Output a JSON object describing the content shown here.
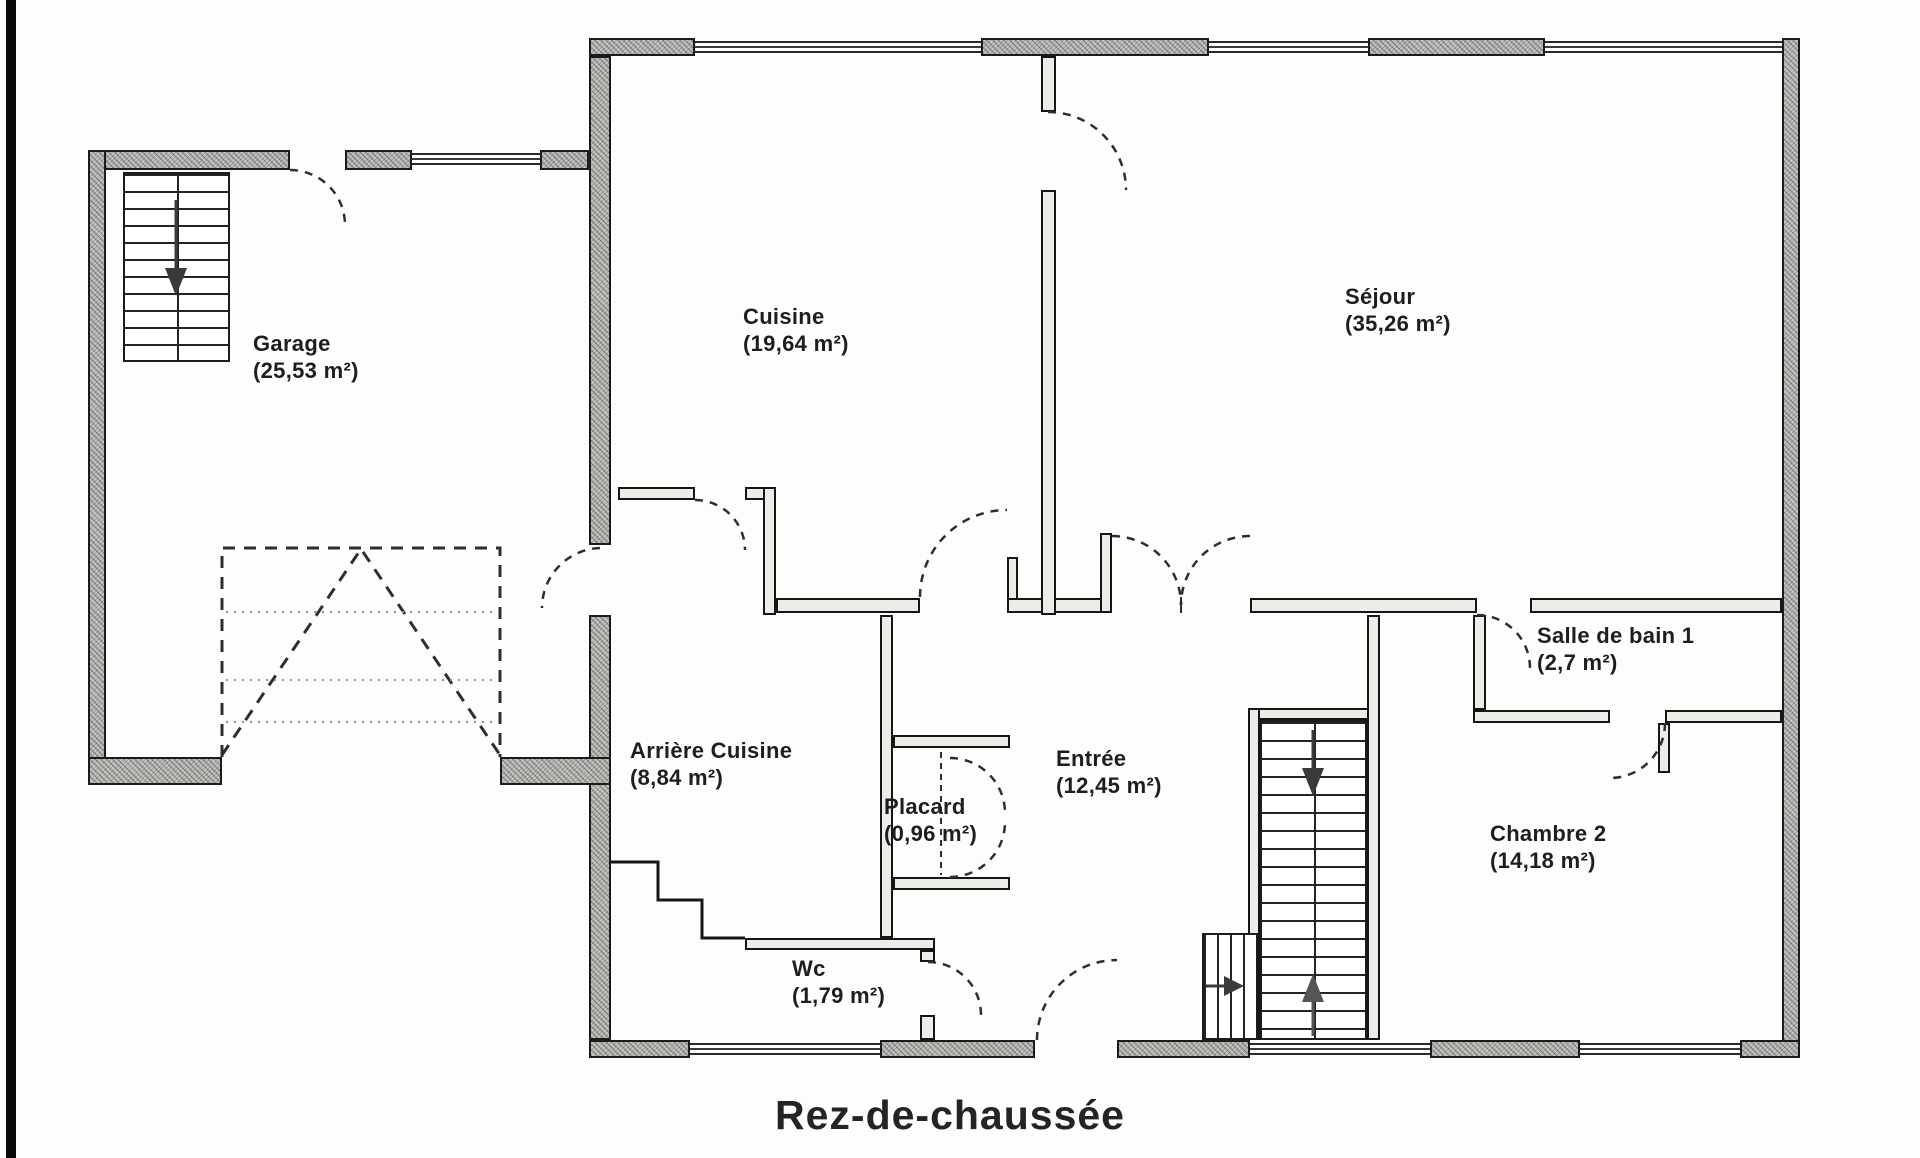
{
  "page": {
    "title": "Rez-de-chaussée"
  },
  "floor_plan": {
    "rooms": [
      {
        "id": "garage",
        "name": "Garage",
        "area": "(25,53 m²)"
      },
      {
        "id": "cuisine",
        "name": "Cuisine",
        "area": "(19,64 m²)"
      },
      {
        "id": "sejour",
        "name": "Séjour",
        "area": "(35,26 m²)"
      },
      {
        "id": "arriere-cuisine",
        "name": "Arrière Cuisine",
        "area": "(8,84 m²)"
      },
      {
        "id": "placard",
        "name": "Placard",
        "area": "(0,96 m²)"
      },
      {
        "id": "entree",
        "name": "Entrée",
        "area": "(12,45 m²)"
      },
      {
        "id": "wc",
        "name": "Wc",
        "area": "(1,79 m²)"
      },
      {
        "id": "salle-de-bain-1",
        "name": "Salle de bain 1",
        "area": "(2,7 m²)"
      },
      {
        "id": "chambre-2",
        "name": "Chambre 2",
        "area": "(14,18 m²)"
      }
    ],
    "colors": {
      "wall_fill": "#c3c3c0",
      "line": "#1b1b1b",
      "paper": "#fdfdfc"
    },
    "icons": [
      "stair-down-arrow-icon",
      "stair-up-arrow-icon",
      "steps-right-arrow-icon"
    ]
  }
}
